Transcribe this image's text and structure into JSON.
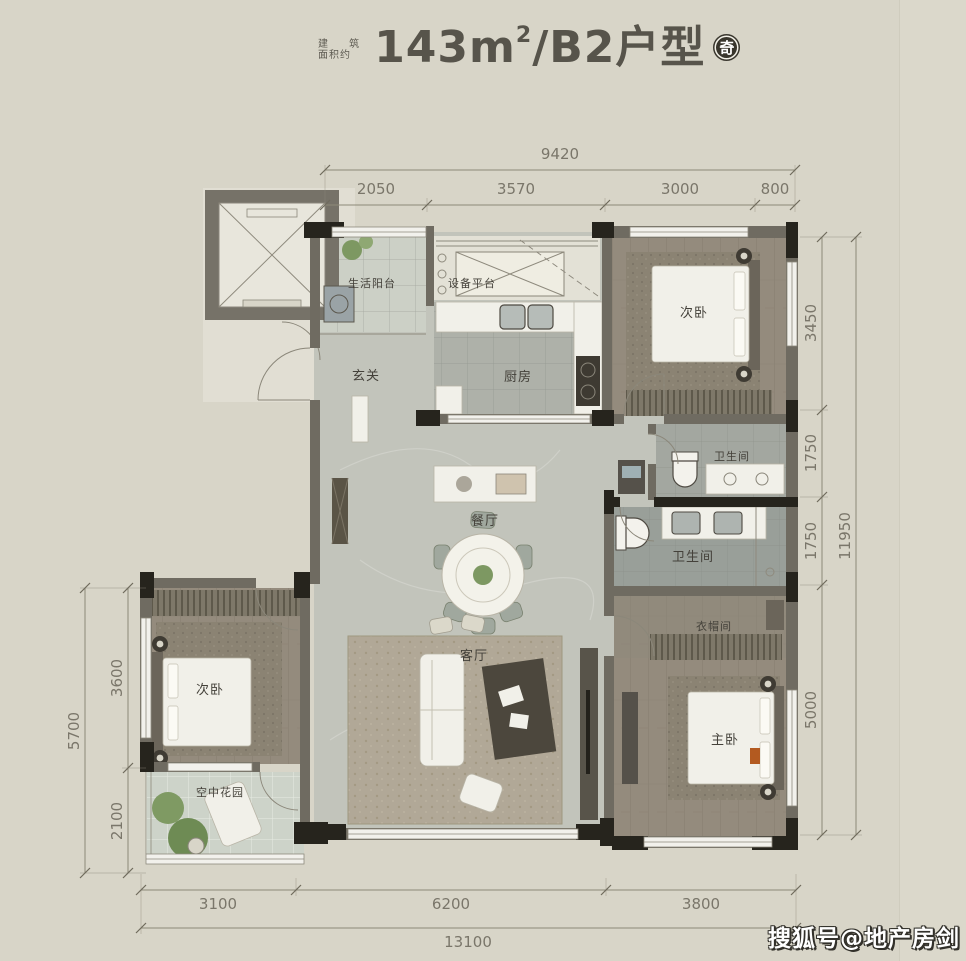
{
  "title": {
    "area_prefix_line1": "建 筑",
    "area_prefix_line2": "面积约",
    "area_value": "143m",
    "area_sup": "2",
    "plan_name": "/B2户型",
    "badge": "奇"
  },
  "rooms": {
    "life_balcony": "生活阳台",
    "equipment_platform": "设备平台",
    "foyer": "玄关",
    "kitchen": "厨房",
    "bedroom_top": "次卧",
    "bath_top": "卫生间",
    "dining": "餐厅",
    "bath_mid": "卫生间",
    "cloakroom": "衣帽间",
    "living": "客厅",
    "bedroom_left": "次卧",
    "master_bedroom": "主卧",
    "sky_garden": "空中花园"
  },
  "dims": {
    "top": {
      "total": "9420",
      "segs": [
        "2050",
        "3570",
        "3000",
        "800"
      ]
    },
    "right": {
      "total": "11950",
      "segs": [
        "3450",
        "1750",
        "1750",
        "5000"
      ]
    },
    "left": {
      "total": "5700",
      "segs": [
        "3600",
        "2100"
      ]
    },
    "bottom": {
      "total": "13100",
      "segs": [
        "3100",
        "6200",
        "3800"
      ]
    }
  },
  "watermark": "搜狐号@地产房剑",
  "colors": {
    "background": "#d8d5c8",
    "wall_gray": "#6f6b61",
    "wall_black": "#26241d",
    "floor_marble": "#c2c4bb",
    "floor_wood": "#948b7d",
    "floor_tile": "#a7aaa3",
    "plant_green": "#7d9862",
    "dim_text": "#7a766a",
    "title_text": "#57544b",
    "watermark_fill": "#ffffff",
    "watermark_outline": "#32302a"
  }
}
